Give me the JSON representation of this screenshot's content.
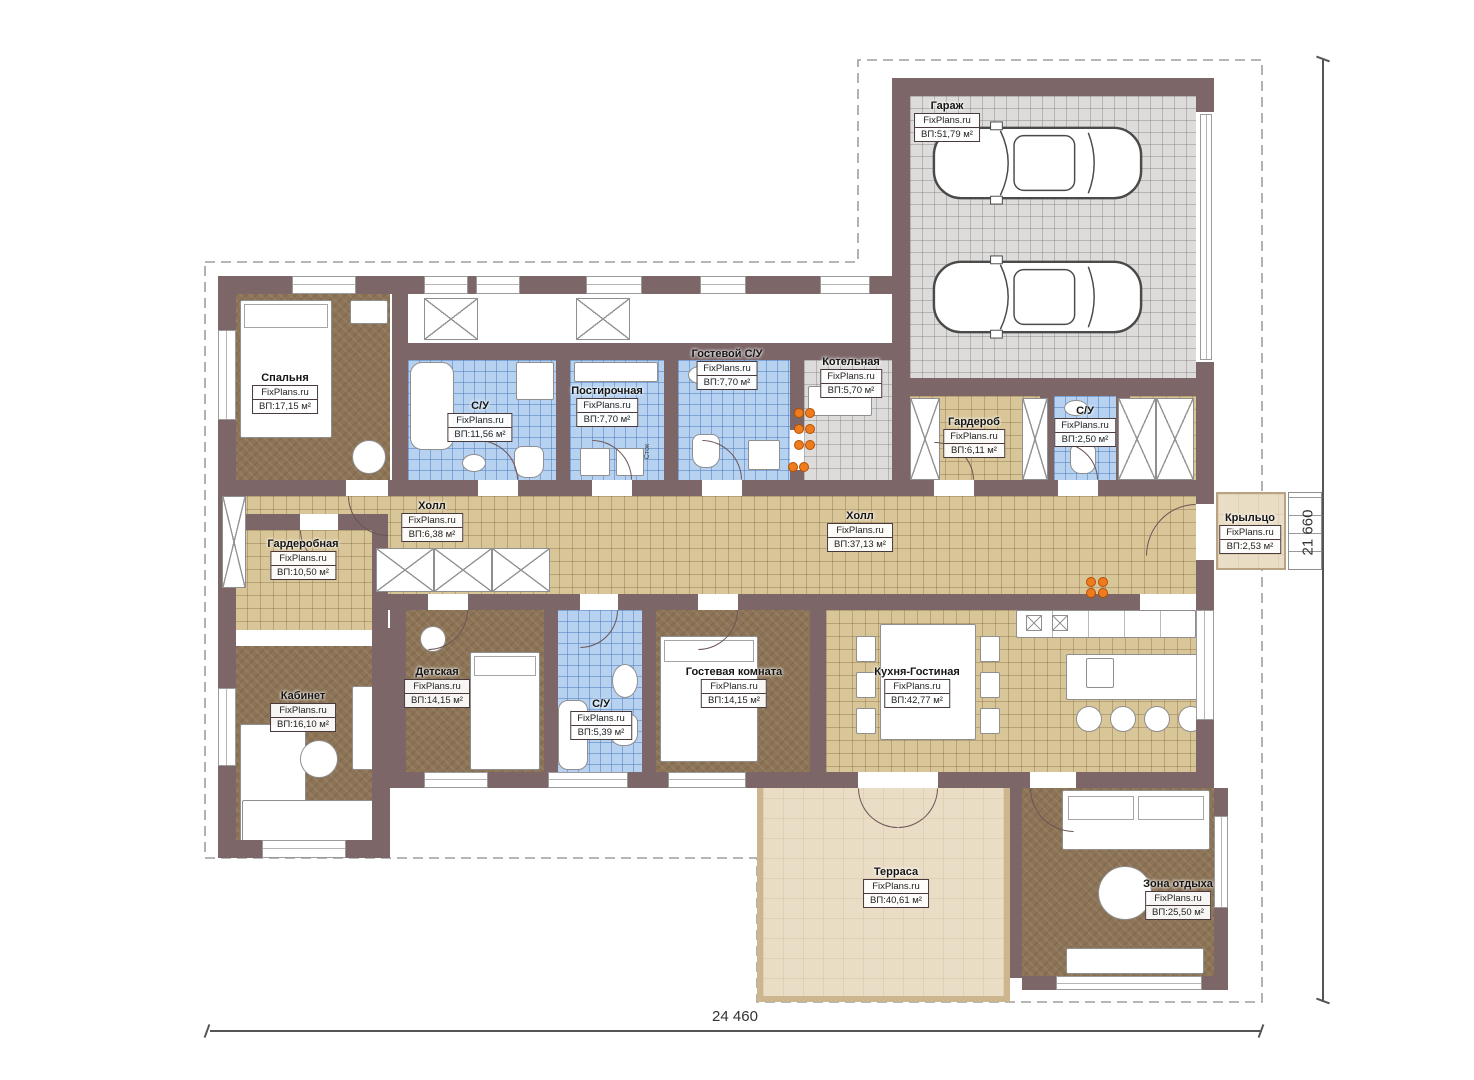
{
  "watermark": "FixPlans.ru",
  "shaft_label": "Сток",
  "dimensions": {
    "bottom": "24 460",
    "right": "21 660"
  },
  "colors": {
    "wall": "#7c6668",
    "tile_beige": "#d8c598",
    "tile_blue": "#b6d2f0",
    "tile_gray": "#dddcda",
    "carpet_brown": "#8d7456",
    "terrace": "#eaddc6",
    "accent_orange": "#ee7c1e"
  },
  "rooms": [
    {
      "id": "garage",
      "name": "Гараж",
      "area": "ВП:51,79 м²"
    },
    {
      "id": "bedroom",
      "name": "Спальня",
      "area": "ВП:17,15 м²"
    },
    {
      "id": "bath-main",
      "name": "С/У",
      "area": "ВП:11,56 м²"
    },
    {
      "id": "laundry",
      "name": "Постирочная",
      "area": "ВП:7,70 м²"
    },
    {
      "id": "guest-wc",
      "name": "Гостевой С/У",
      "area": "ВП:7,70 м²"
    },
    {
      "id": "boiler",
      "name": "Котельная",
      "area": "ВП:5,70 м²"
    },
    {
      "id": "wardrobe",
      "name": "Гардероб",
      "area": "ВП:6,11 м²"
    },
    {
      "id": "wc-garage",
      "name": "С/У",
      "area": "ВП:2,50 м²"
    },
    {
      "id": "hall-small",
      "name": "Холл",
      "area": "ВП:6,38 м²"
    },
    {
      "id": "hall-main",
      "name": "Холл",
      "area": "ВП:37,13 м²"
    },
    {
      "id": "dressing",
      "name": "Гардеробная",
      "area": "ВП:10,50 м²"
    },
    {
      "id": "office",
      "name": "Кабинет",
      "area": "ВП:16,10 м²"
    },
    {
      "id": "kids",
      "name": "Детская",
      "area": "ВП:14,15 м²"
    },
    {
      "id": "wc-mid",
      "name": "С/У",
      "area": "ВП:5,39 м²"
    },
    {
      "id": "guest-room",
      "name": "Гостевая комната",
      "area": "ВП:14,15 м²"
    },
    {
      "id": "kitchen",
      "name": "Кухня-Гостиная",
      "area": "ВП:42,77 м²"
    },
    {
      "id": "porch",
      "name": "Крыльцо",
      "area": "ВП:2,53 м²"
    },
    {
      "id": "terrace",
      "name": "Терраса",
      "area": "ВП:40,61 м²"
    },
    {
      "id": "lounge",
      "name": "Зона отдыха",
      "area": "ВП:25,50 м²"
    }
  ]
}
